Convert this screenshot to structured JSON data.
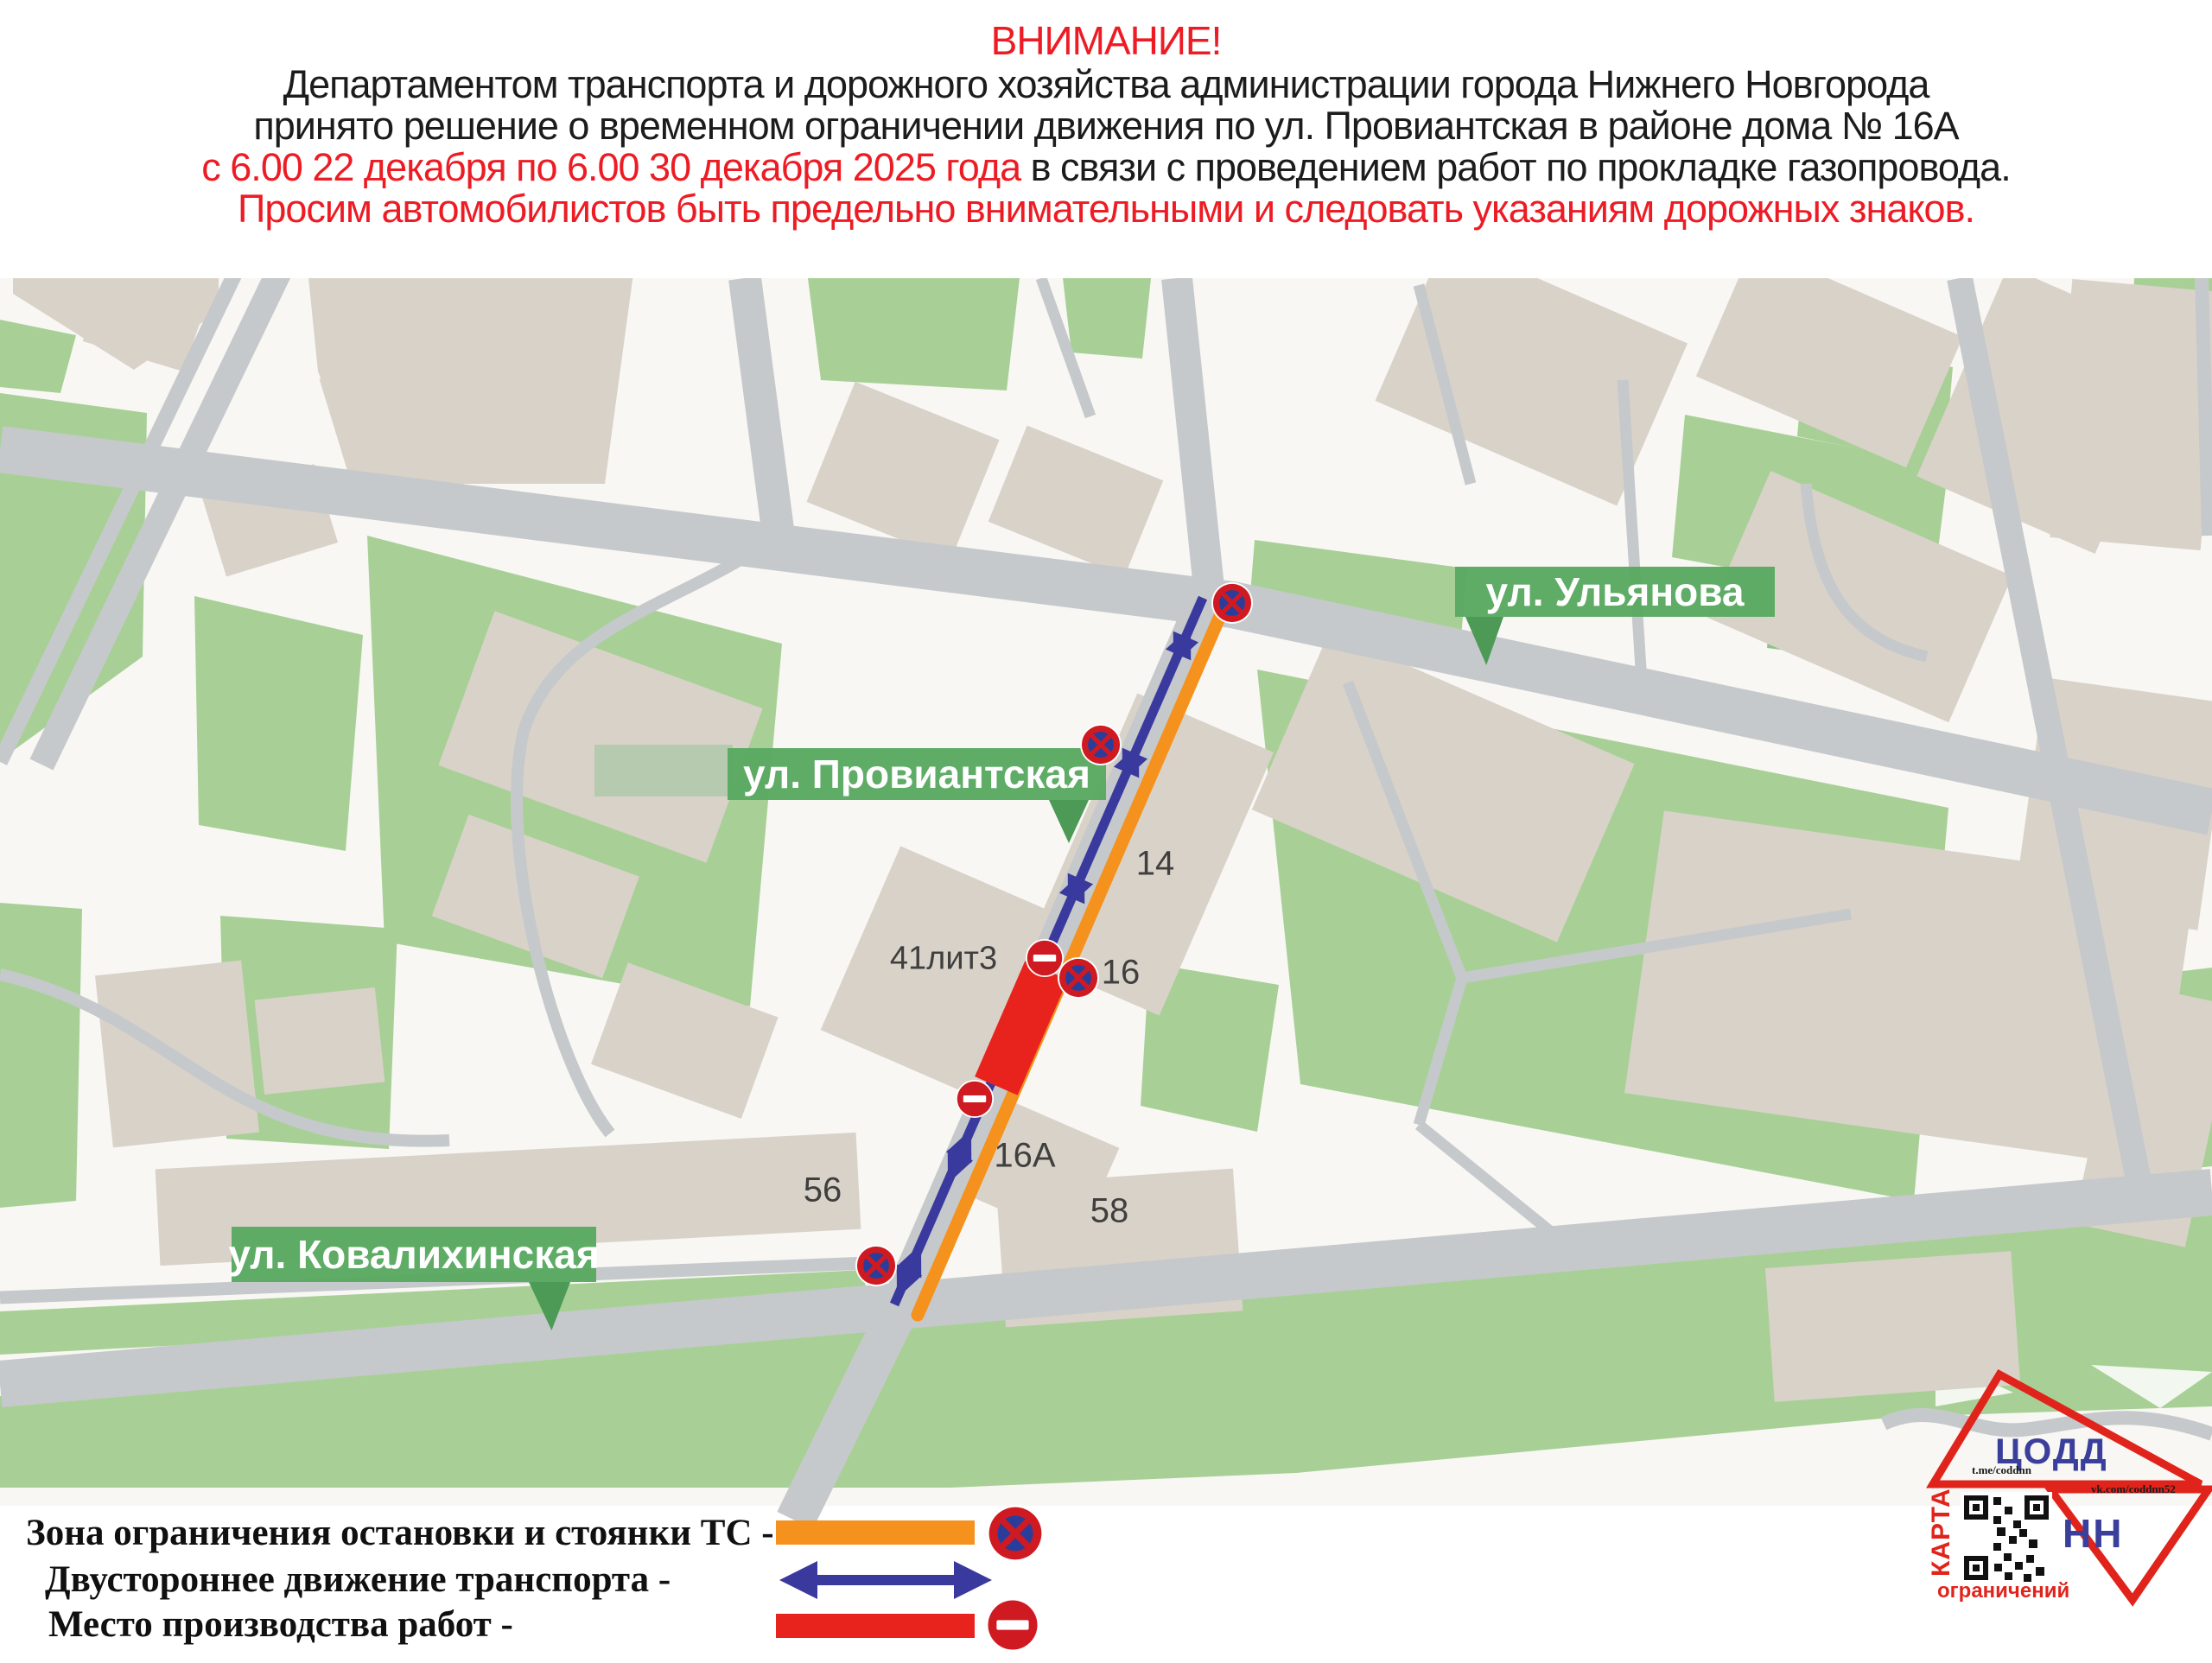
{
  "header": {
    "title": "ВНИМАНИЕ!",
    "line1": "Департаментом транспорта и дорожного хозяйства администрации города Нижнего Новгорода",
    "line2": "принято решение о временном ограничении движения по ул. Провиантская в районе дома № 16А",
    "line3_red": "с 6.00 22 декабря по 6.00 30 декабря 2025 года",
    "line3_black": " в связи с проведением работ по прокладке газопровода.",
    "line4": "Просим автомобилистов быть предельно внимательными и следовать указаниям дорожных знаков."
  },
  "map": {
    "labels": {
      "ulyanova": "ул. Ульянова",
      "proviantskaya": "ул. Провиантская",
      "kovalikhinskaya": "ул. Ковалихинская"
    },
    "buildings": [
      {
        "id": "b14",
        "label": "14"
      },
      {
        "id": "b41",
        "label": "41лит3"
      },
      {
        "id": "b16",
        "label": "16"
      },
      {
        "id": "b16a",
        "label": "16А"
      },
      {
        "id": "b56",
        "label": "56"
      },
      {
        "id": "b58",
        "label": "58"
      }
    ],
    "signs": {
      "no_stopping_count": 4,
      "no_entry_count": 2,
      "work_zone_count": 1
    }
  },
  "legend": {
    "items": [
      {
        "label": "Зона ограничения остановки и стоянки ТС -",
        "symbol": "no-stopping-zone"
      },
      {
        "label": "Двустороннее движение транспорта -",
        "symbol": "two-way-traffic"
      },
      {
        "label": "Место производства работ -",
        "symbol": "work-site"
      }
    ]
  },
  "logo": {
    "org": "ЦОДД",
    "city": "НН",
    "telegram": "t.me/coddnn",
    "vk": "vk.com/coddnn52",
    "karta_line1": "КАРТА",
    "karta_line2": "ограничений"
  },
  "colors": {
    "accent_red": "#ed1c24",
    "map_red": "#e8231d",
    "orange": "#f5921e",
    "arrow_blue": "#3a3a9e",
    "badge_green": "#58a961",
    "park_green": "#a8d096",
    "building_beige": "#d9d2c9",
    "road_gray": "#c6c9cb"
  }
}
